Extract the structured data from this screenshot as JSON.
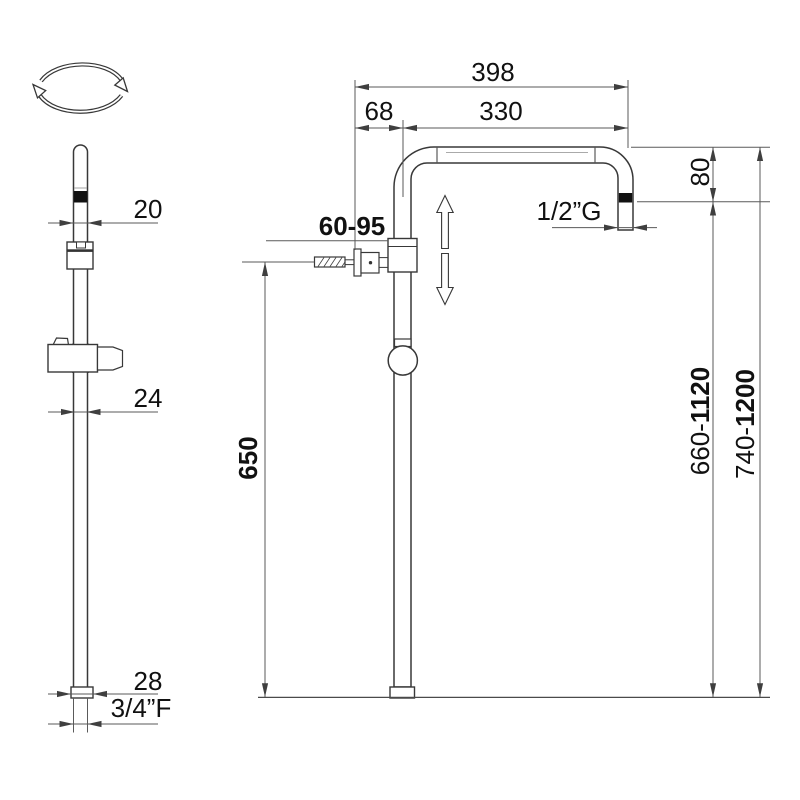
{
  "figure": {
    "kind": "technical-dimension-drawing",
    "colors": {
      "line": "#383838",
      "dimension_line": "#5a5a5a",
      "text": "#111111",
      "band": "#111111",
      "background": "#ffffff"
    },
    "icons": [
      "rotation-icon",
      "up-adjust-arrow-icon",
      "down-adjust-arrow-icon"
    ],
    "left_view": {
      "dim_top_diameter": "20",
      "dim_mid_diameter": "24",
      "dim_bottom_diameter": "28",
      "dim_bottom_thread": "3/4”F"
    },
    "right_view": {
      "dim_total_width": "398",
      "dim_wall_offset": "68",
      "dim_arm_reach": "330",
      "dim_bracket_range": "60-95",
      "dim_outlet_thread": "1/2”G",
      "dim_outlet_drop": "80",
      "dim_bracket_height": "650",
      "dim_height_inner_prefix": "660-",
      "dim_height_inner_max": "1120",
      "dim_height_outer_prefix": "740-",
      "dim_height_outer_max": "1200"
    }
  }
}
